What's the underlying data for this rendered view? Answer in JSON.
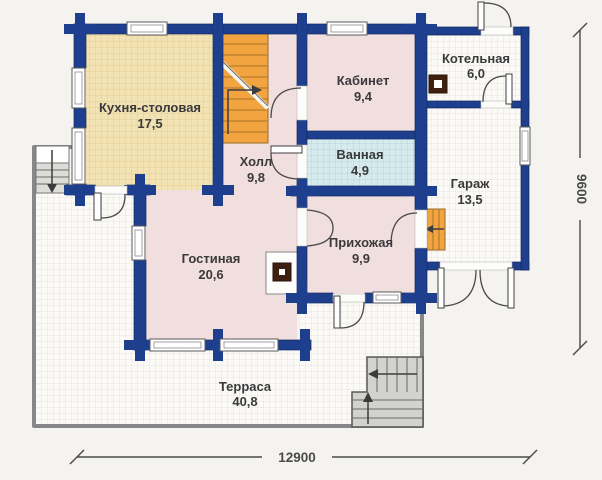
{
  "rooms": {
    "kitchen": {
      "name": "Кухня-столовая",
      "area": "17,5"
    },
    "hall": {
      "name": "Холл",
      "area": "9,8"
    },
    "study": {
      "name": "Кабинет",
      "area": "9,4"
    },
    "boiler": {
      "name": "Котельная",
      "area": "6,0"
    },
    "bathroom": {
      "name": "Ванная",
      "area": "4,9"
    },
    "garage": {
      "name": "Гараж",
      "area": "13,5"
    },
    "entry_hall": {
      "name": "Прихожая",
      "area": "9,9"
    },
    "living": {
      "name": "Гостиная",
      "area": "20,6"
    },
    "terrace": {
      "name": "Терраса",
      "area": "40,8"
    }
  },
  "dimensions": {
    "overall_width_mm": "12900",
    "overall_depth_mm": "9600"
  },
  "icons": {
    "fireplace": "fireplace-icon",
    "boiler_unit": "boiler-icon",
    "stairs_direction": "stairs-up-arrow"
  },
  "colors": {
    "wall": "#1d3f8e",
    "kitchen_floor": "#f3e3b4",
    "wet_room_floor": "#d6ebee",
    "room_floor": "#f1dede",
    "stairs": "#f2a441",
    "terrace_floor": "#fbfaf6",
    "terrace_edge": "#87878a",
    "label_text": "#3a3a3c",
    "dimension_text": "#4a4a4c"
  }
}
